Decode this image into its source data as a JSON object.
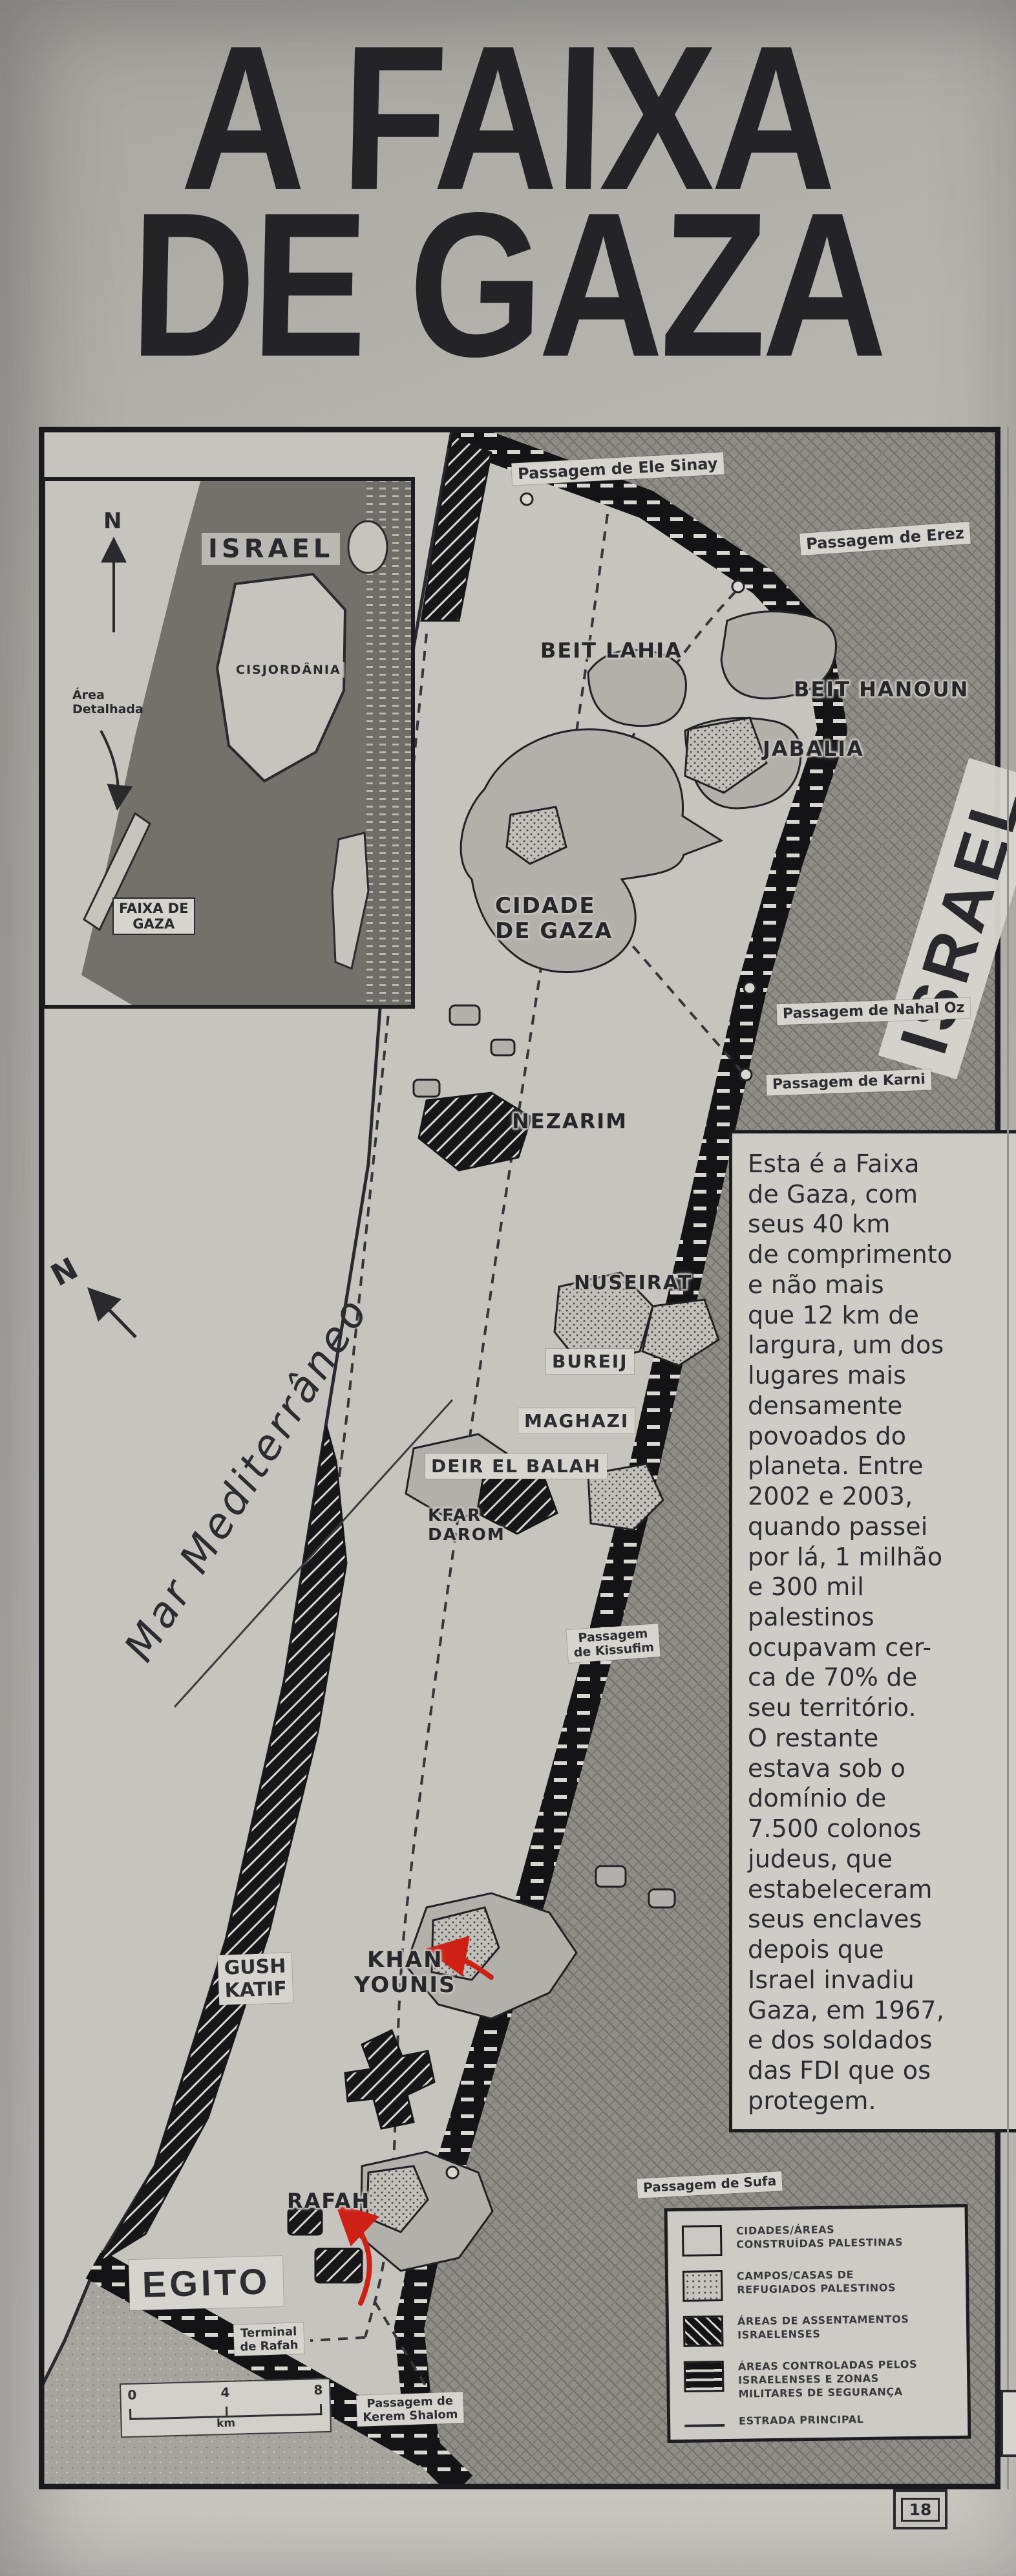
{
  "title": {
    "line1": "A FAIXA",
    "line2": "DE GAZA"
  },
  "inset": {
    "north": "N",
    "israel": "ISRAEL",
    "cisjordania": "CISJORDÂNIA",
    "area_detalhada": "Área\nDetalhada",
    "faixa_de_gaza": "FAIXA DE\nGAZA"
  },
  "sea": {
    "label": "Mar Mediterrâneo",
    "north": "N"
  },
  "israel_label": "ISRAEL",
  "egypt_label": "EGITO",
  "places": {
    "beit_lahia": "BEIT LAHIA",
    "beit_hanoun": "BEIT HANOUN",
    "jabalia": "JABALIA",
    "cidade_de_gaza": "CIDADE\nDE GAZA",
    "nezarim": "NEZARIM",
    "nuseirat": "NUSEIRAT",
    "bureij": "BUREIJ",
    "maghazi": "MAGHAZI",
    "deir_el_balah": "DEIR EL BALAH",
    "kfar_darom": "KFAR\nDAROM",
    "gush_katif": "GUSH\nKATIF",
    "khan_younis": "KHAN\nYOUNIS",
    "rafah": "RAFAH"
  },
  "crossings": {
    "ele_sinay": "Passagem de Ele Sinay",
    "erez": "Passagem de Erez",
    "nahal_oz": "Passagem de Nahal Oz",
    "karni": "Passagem de Karni",
    "kissufim": "Passagem\nde Kissufim",
    "sufa": "Passagem de Sufa",
    "terminal_rafah": "Terminal\nde Rafah",
    "kerem_shalom": "Passagem de\nKerem Shalom"
  },
  "narration": "Esta é a Faixa\nde Gaza, com\nseus 40 km\nde comprimento\ne não mais\nque 12 km de\nlargura, um dos\nlugares mais\ndensamente\npovoados do\nplaneta. Entre\n2002 e 2003,\nquando passei\npor lá, 1 milhão\ne 300 mil\npalestinos\nocupavam cer-\nca de 70% de\nseu território.\nO restante\nestava sob o\ndomínio de\n7.500 colonos\njudeus, que\nestabeleceram\nseus enclaves\ndepois que\nIsrael invadiu\nGaza, em 1967,\ne dos soldados\ndas FDI que os\nprotegem.",
  "scalebar": {
    "t0": "0",
    "t4": "4",
    "t8": "8",
    "unit": "km"
  },
  "legend": {
    "items": [
      {
        "key": "palestinian-built",
        "label": "CIDADES/ÁREAS\nCONSTRUÍDAS PALESTINAS"
      },
      {
        "key": "refugee-camps",
        "label": "CAMPOS/CASAS DE\nREFUGIADOS PALESTINOS"
      },
      {
        "key": "israeli-settlements",
        "label": "ÁREAS DE ASSENTAMENTOS\nISRAELENSES"
      },
      {
        "key": "israeli-controlled",
        "label": "ÁREAS CONTROLADAS PELOS\nISRAELENSES E ZONAS\nMILITARES DE SEGURANÇA"
      },
      {
        "key": "main-road",
        "label": "ESTRADA PRINCIPAL"
      }
    ]
  },
  "page_number": "18",
  "colors": {
    "red_annotation": "#cf2016",
    "paper": "#c6c4be",
    "ink": "#1d1d20"
  }
}
